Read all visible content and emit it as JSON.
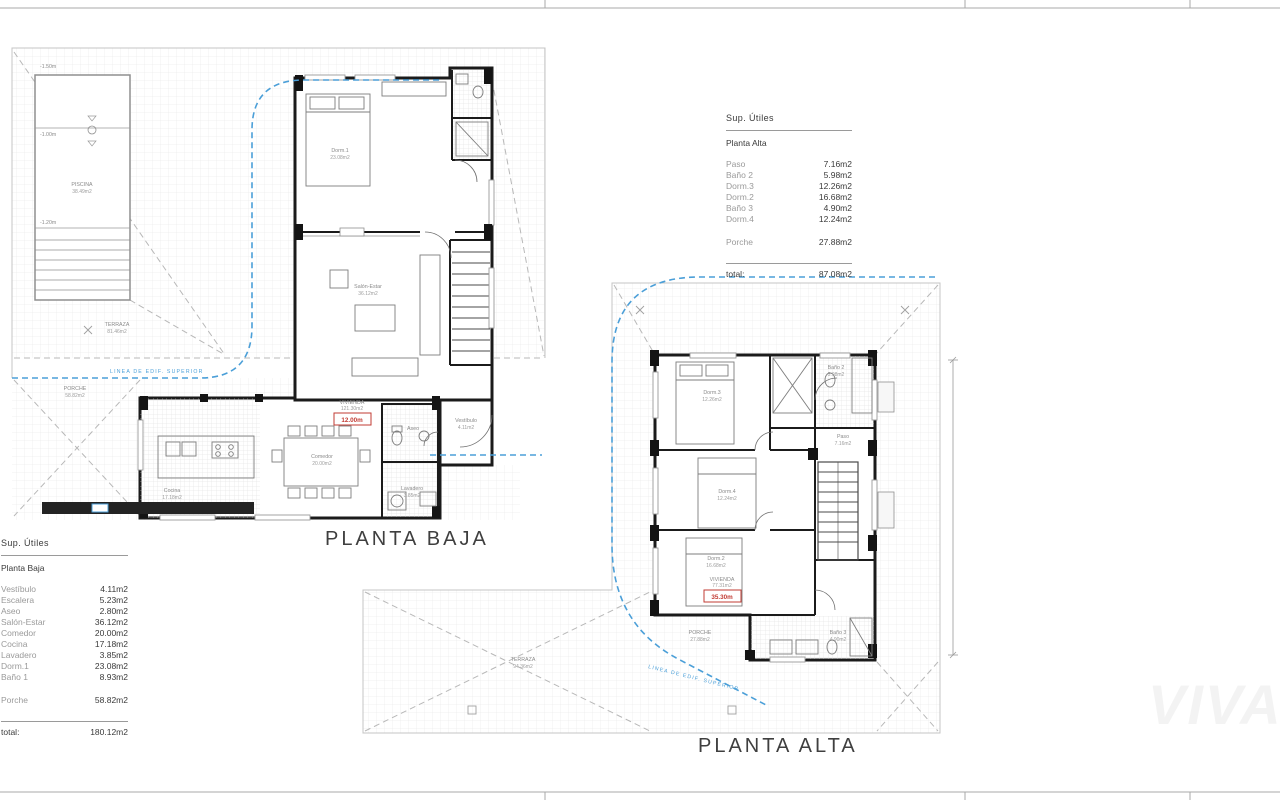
{
  "plans": {
    "planta_baja": {
      "title": "PLANTA BAJA",
      "labels": {
        "piscina": "PISCINA",
        "piscina_area": "38.49m2",
        "terraza": "TERRAZA",
        "terraza_area": "81.46m2",
        "porche": "PORCHE",
        "porche_area": "58.82m2",
        "vivienda": "VIVIENDA",
        "vivienda_area": "121.30m2",
        "cota_roja": "12.00m",
        "linea": "LINEA DE EDIF. SUPERIOR",
        "depth_1": "-1.50m",
        "depth_2": "-1.00m",
        "depth_3": "-1.20m",
        "dorm1": "Dorm.1",
        "dorm1_area": "23.08m2",
        "salon": "Salón-Estar",
        "salon_area": "36.12m2",
        "comedor": "Comedor",
        "comedor_area": "20.00m2",
        "cocina": "Cocina",
        "cocina_area": "17.18m2",
        "vestibulo": "Vestíbulo",
        "vestibulo_area": "4.11m2",
        "aseo": "Aseo",
        "aseo_area": "2.80m2",
        "lavadero": "Lavadero",
        "lavadero_area": "3.85m2"
      }
    },
    "planta_alta": {
      "title": "PLANTA ALTA",
      "labels": {
        "terraza": "TERRAZA",
        "terraza_area": "94.36m2",
        "porche": "PORCHE",
        "porche_area": "27.88m2",
        "vivienda": "VIVIENDA",
        "vivienda_area": "77.31m2",
        "cota_roja": "35.30m",
        "linea": "LINEA DE EDIF. SUPERIOR",
        "dorm3": "Dorm.3",
        "dorm3_area": "12.26m2",
        "dorm4": "Dorm.4",
        "dorm4_area": "12.24m2",
        "dorm2": "Dorm.2",
        "dorm2_area": "16.68m2",
        "bano2": "Baño 2",
        "bano2_area": "5.98m2",
        "bano3": "Baño 3",
        "bano3_area": "4.90m2",
        "paso": "Paso",
        "paso_area": "7.16m2"
      }
    }
  },
  "tables": {
    "planta_alta": {
      "header": "Sup. Útiles",
      "subtitle": "Planta Alta",
      "rows": [
        {
          "label": "Paso",
          "value": "7.16m2"
        },
        {
          "label": "Baño 2",
          "value": "5.98m2"
        },
        {
          "label": "Dorm.3",
          "value": "12.26m2"
        },
        {
          "label": "Dorm.2",
          "value": "16.68m2"
        },
        {
          "label": "Baño 3",
          "value": "4.90m2"
        },
        {
          "label": "Dorm.4",
          "value": "12.24m2"
        }
      ],
      "porche": {
        "label": "Porche",
        "value": "27.88m2"
      },
      "total": {
        "label": "total:",
        "value": "87.08m2"
      }
    },
    "planta_baja": {
      "header": "Sup. Útiles",
      "subtitle": "Planta Baja",
      "rows": [
        {
          "label": "Vestíbulo",
          "value": "4.11m2"
        },
        {
          "label": "Escalera",
          "value": "5.23m2"
        },
        {
          "label": "Aseo",
          "value": "2.80m2"
        },
        {
          "label": "Salón-Estar",
          "value": "36.12m2"
        },
        {
          "label": "Comedor",
          "value": "20.00m2"
        },
        {
          "label": "Cocina",
          "value": "17.18m2"
        },
        {
          "label": "Lavadero",
          "value": "3.85m2"
        },
        {
          "label": "Dorm.1",
          "value": "23.08m2"
        },
        {
          "label": "Baño 1",
          "value": "8.93m2"
        }
      ],
      "porche": {
        "label": "Porche",
        "value": "58.82m2"
      },
      "total": {
        "label": "total:",
        "value": "180.12m2"
      }
    }
  },
  "watermark": "VIVA",
  "colors": {
    "accent_blue": "#4b9fd8",
    "accent_red": "#c23b33"
  }
}
